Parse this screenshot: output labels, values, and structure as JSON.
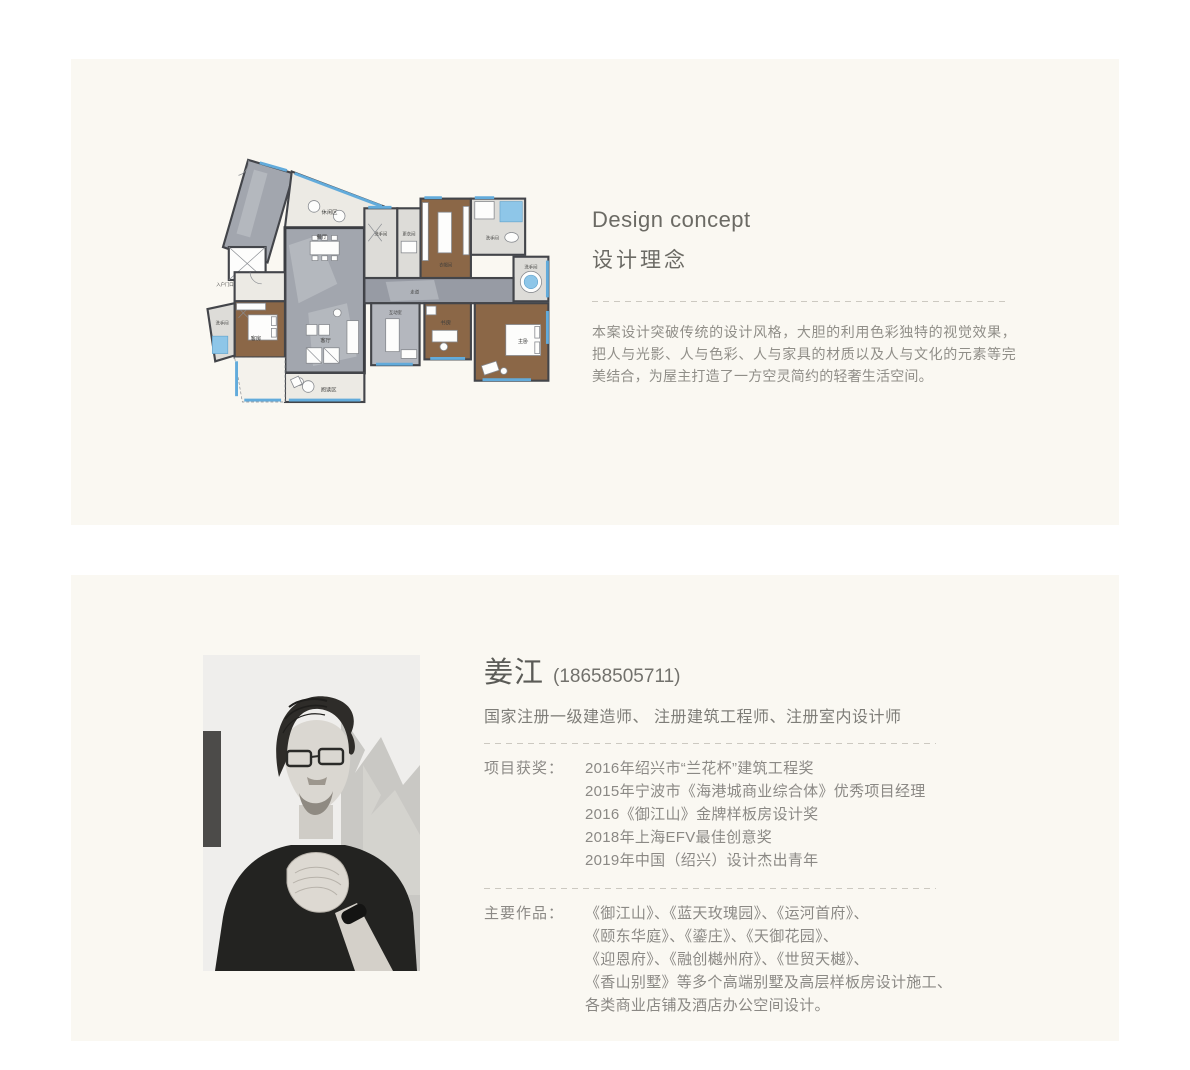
{
  "panel1": {
    "title_en": "Design concept",
    "title_zh": "设计理念",
    "description": "本案设计突破传统的设计风格，大胆的利用色彩独特的视觉效果，把人与光影、人与色彩、人与家具的材质以及人与文化的元素等完美结合，为屋主打造了一方空灵简约的轻奢生活空间。",
    "floorplan": {
      "rooms": [
        "休闲区",
        "餐厅",
        "洗手间",
        "更衣间",
        "衣帽间",
        "洗手间",
        "洗手间",
        "走道",
        "入户门口",
        "洗手间",
        "客房",
        "客厅",
        "互动室",
        "书房",
        "主卧",
        "阅读区"
      ]
    }
  },
  "panel2": {
    "name": "姜江",
    "phone": "(18658505711)",
    "credentials": "国家注册一级建造师、 注册建筑工程师、注册室内设计师",
    "awards_label": "项目获奖：",
    "awards": [
      "2016年绍兴市“兰花杯”建筑工程奖",
      "2015年宁波市《海港城商业综合体》优秀项目经理",
      "2016《御江山》金牌样板房设计奖",
      "2018年上海EFV最佳创意奖",
      "2019年中国（绍兴）设计杰出青年"
    ],
    "works_label": "主要作品：",
    "works": [
      "《御江山》、《蓝天玫瑰园》、《运河首府》、",
      "《颐东华庭》、《鎏庄》、《天御花园》、",
      "《迎恩府》、《融创樾州府》、《世贸天樾》、",
      "《香山别墅》等多个高端别墅及高层样板房设计施工、",
      "各类商业店铺及酒店办公空间设计。"
    ]
  },
  "colors": {
    "panel_bg": "#faf8f2",
    "heading": "#6b6a64",
    "body_text": "#8b8985",
    "dash": "#ccc9c1",
    "plan_blue": "#62abdb",
    "plan_wood": "#8b6747",
    "plan_marble": "#a2a6ae"
  }
}
